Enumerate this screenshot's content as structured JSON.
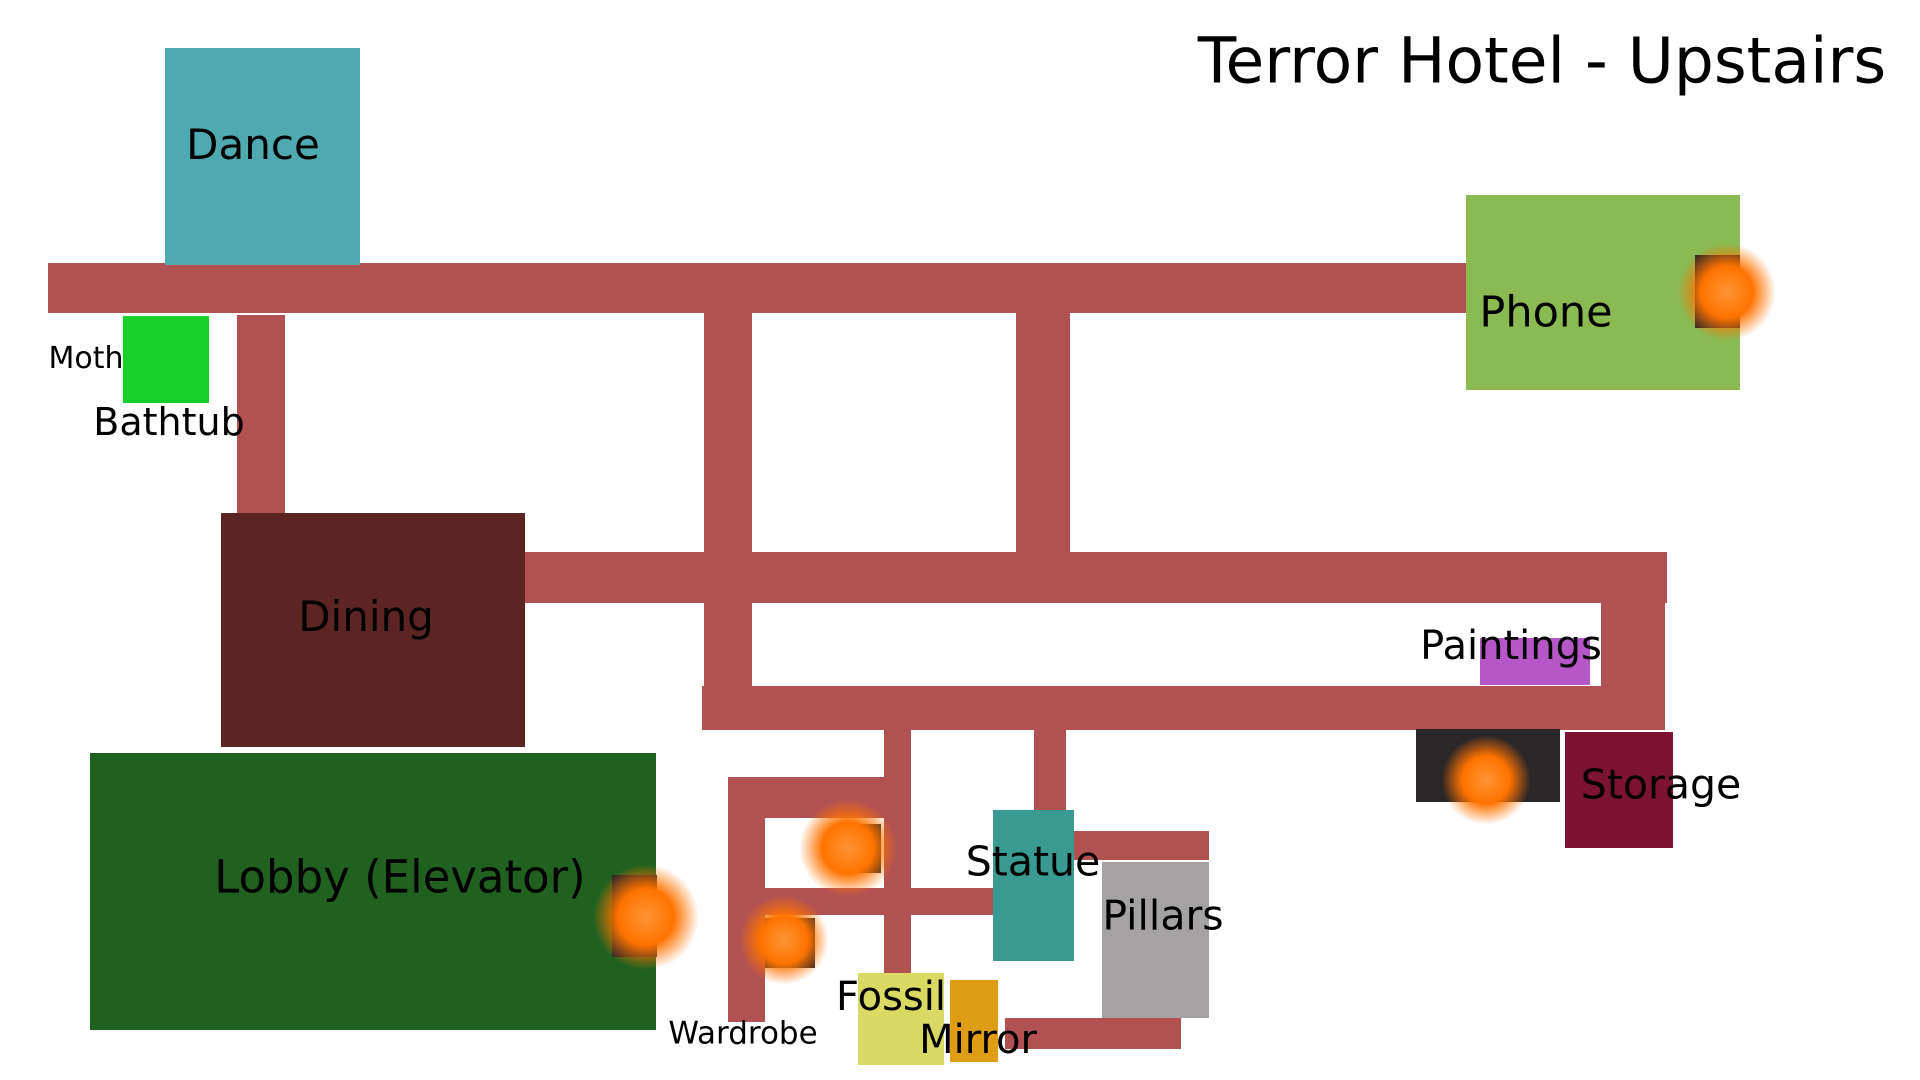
{
  "title": "Terror Hotel - Upstairs",
  "title_pos": {
    "cx": 1542,
    "cy": 61,
    "size": 63
  },
  "colors": {
    "background": "#ffffff",
    "corridor": "#b25151",
    "dark_square": "#2b2628",
    "glow_orange": "#ff7300",
    "label_text": "#000000"
  },
  "rooms": [
    {
      "id": "dance",
      "label": "Dance",
      "x": 165,
      "y": 48,
      "w": 195,
      "h": 217,
      "color": "#4fa9b1",
      "label_cx": 253,
      "label_cy": 145,
      "label_size": 42
    },
    {
      "id": "moth-room",
      "label": "",
      "x": 123,
      "y": 316,
      "w": 86,
      "h": 87,
      "color": "#17d02a",
      "label_cx": 0,
      "label_cy": 0,
      "label_size": 0
    },
    {
      "id": "dining",
      "label": "Dining",
      "x": 221,
      "y": 513,
      "w": 304,
      "h": 234,
      "color": "#5c2523",
      "label_cx": 366,
      "label_cy": 617,
      "label_size": 42
    },
    {
      "id": "lobby",
      "label": "Lobby (Elevator)",
      "x": 90,
      "y": 753,
      "w": 566,
      "h": 277,
      "color": "#20611f",
      "label_cx": 400,
      "label_cy": 877,
      "label_size": 45
    },
    {
      "id": "phone",
      "label": "Phone",
      "x": 1466,
      "y": 195,
      "w": 274,
      "h": 195,
      "color": "#8aba51",
      "label_cx": 1546,
      "label_cy": 313,
      "label_size": 43
    },
    {
      "id": "paintings",
      "label": "Paintings",
      "x": 1480,
      "y": 638,
      "w": 110,
      "h": 47,
      "color": "#b557c6",
      "label_cx": 1511,
      "label_cy": 646,
      "label_size": 40
    },
    {
      "id": "storage",
      "label": "Storage",
      "x": 1565,
      "y": 732,
      "w": 108,
      "h": 116,
      "color": "#7c1333",
      "label_cx": 1661,
      "label_cy": 785,
      "label_size": 41
    },
    {
      "id": "statue",
      "label": "Statue",
      "x": 993,
      "y": 810,
      "w": 81,
      "h": 151,
      "color": "#389a90",
      "label_cx": 1033,
      "label_cy": 862,
      "label_size": 41
    },
    {
      "id": "pillars",
      "label": "Pillars",
      "x": 1102,
      "y": 862,
      "w": 107,
      "h": 156,
      "color": "#a4a2a3",
      "label_cx": 1163,
      "label_cy": 916,
      "label_size": 41
    },
    {
      "id": "fossil",
      "label": "Fossil",
      "x": 858,
      "y": 973,
      "w": 86,
      "h": 92,
      "color": "#d9da63",
      "label_cx": 891,
      "label_cy": 997,
      "label_size": 40
    },
    {
      "id": "mirror",
      "label": "Mirror",
      "x": 950,
      "y": 980,
      "w": 48,
      "h": 82,
      "color": "#df9c15",
      "label_cx": 978,
      "label_cy": 1040,
      "label_size": 40
    }
  ],
  "floating_labels": [
    {
      "id": "moth",
      "text": "Moth",
      "cx": 86,
      "cy": 359,
      "size": 30
    },
    {
      "id": "bathtub",
      "text": "Bathtub",
      "cx": 169,
      "cy": 422,
      "size": 38
    },
    {
      "id": "wardrobe",
      "text": "Wardrobe",
      "cx": 743,
      "cy": 1034,
      "size": 31
    }
  ],
  "corridors": [
    {
      "x": 48,
      "y": 263,
      "w": 1418,
      "h": 50
    },
    {
      "x": 237,
      "y": 315,
      "w": 48,
      "h": 198
    },
    {
      "x": 704,
      "y": 313,
      "w": 48,
      "h": 373
    },
    {
      "x": 1016,
      "y": 313,
      "w": 54,
      "h": 240
    },
    {
      "x": 525,
      "y": 552,
      "w": 1142,
      "h": 51
    },
    {
      "x": 1601,
      "y": 552,
      "w": 64,
      "h": 178
    },
    {
      "x": 702,
      "y": 686,
      "w": 963,
      "h": 44
    },
    {
      "x": 1034,
      "y": 728,
      "w": 32,
      "h": 84
    },
    {
      "x": 884,
      "y": 728,
      "w": 27,
      "h": 245
    },
    {
      "x": 728,
      "y": 777,
      "w": 182,
      "h": 41
    },
    {
      "x": 728,
      "y": 777,
      "w": 37,
      "h": 245
    },
    {
      "x": 765,
      "y": 888,
      "w": 228,
      "h": 27
    },
    {
      "x": 1074,
      "y": 831,
      "w": 135,
      "h": 29
    },
    {
      "x": 1005,
      "y": 1018,
      "w": 176,
      "h": 31
    }
  ],
  "glow_squares": [
    {
      "id": "phone-light",
      "x": 1695,
      "y": 255,
      "w": 45,
      "h": 73,
      "dot_cx": 1727,
      "dot_cy": 292,
      "dot_r": 24
    },
    {
      "id": "storage-light",
      "x": 1416,
      "y": 729,
      "w": 144,
      "h": 73,
      "dot_cx": 1486,
      "dot_cy": 780,
      "dot_r": 22
    },
    {
      "id": "lobby-light",
      "x": 612,
      "y": 875,
      "w": 45,
      "h": 82,
      "dot_cx": 646,
      "dot_cy": 917,
      "dot_r": 26
    },
    {
      "id": "hall-light-upper",
      "x": 839,
      "y": 824,
      "w": 42,
      "h": 49,
      "dot_cx": 848,
      "dot_cy": 848,
      "dot_r": 24
    },
    {
      "id": "hall-light-lower",
      "x": 765,
      "y": 918,
      "w": 50,
      "h": 50,
      "dot_cx": 784,
      "dot_cy": 940,
      "dot_r": 22
    }
  ]
}
